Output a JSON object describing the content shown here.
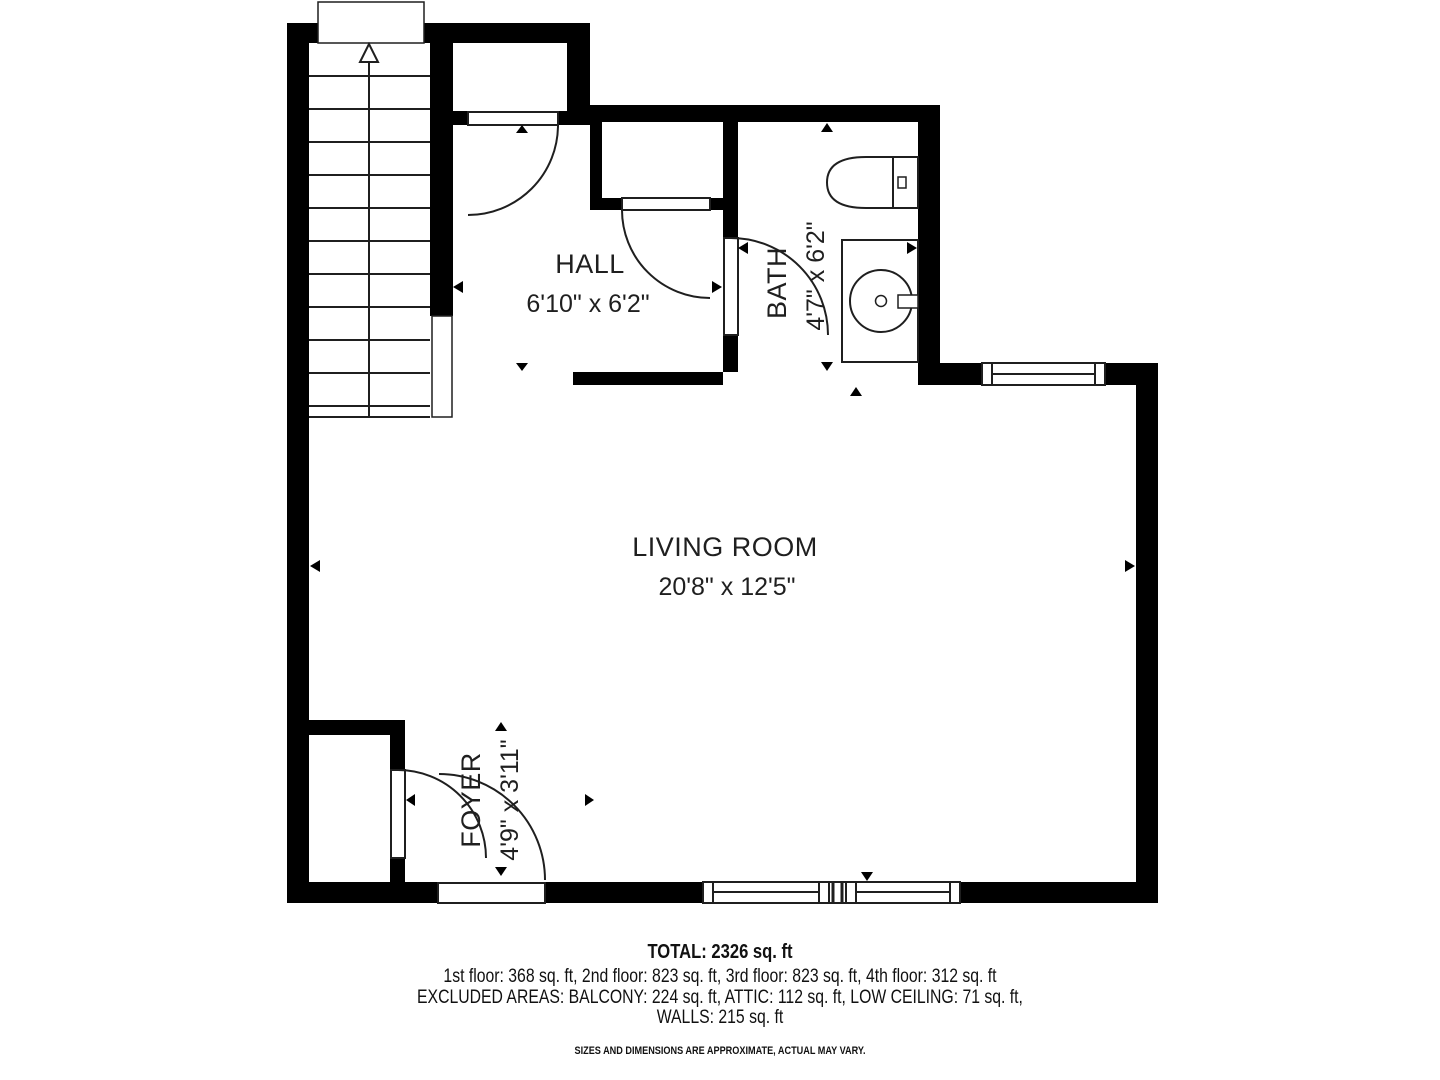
{
  "rooms": {
    "hall": {
      "name": "HALL",
      "dims": "6'10\" x 6'2\""
    },
    "bath": {
      "name": "BATH",
      "dims": "4'7\" x 6'2\""
    },
    "living_room": {
      "name": "LIVING ROOM",
      "dims": "20'8\" x 12'5\""
    },
    "foyer": {
      "name": "FOYER",
      "dims": "4'9\" x 3'11\""
    }
  },
  "footer": {
    "total": "TOTAL: 2326 sq. ft",
    "floors": "1st floor: 368 sq. ft, 2nd floor: 823 sq. ft, 3rd floor: 823 sq. ft, 4th floor: 312 sq. ft",
    "excluded": "EXCLUDED AREAS: BALCONY: 224 sq. ft, ATTIC: 112 sq. ft, LOW CEILING: 71 sq. ft,",
    "walls": "WALLS: 215 sq. ft",
    "disclaimer": "SIZES AND DIMENSIONS ARE APPROXIMATE, ACTUAL MAY VARY."
  },
  "colors": {
    "wall": "#000000",
    "line": "#1f1f1f",
    "text": "#1f1f1f",
    "background": "#ffffff"
  }
}
